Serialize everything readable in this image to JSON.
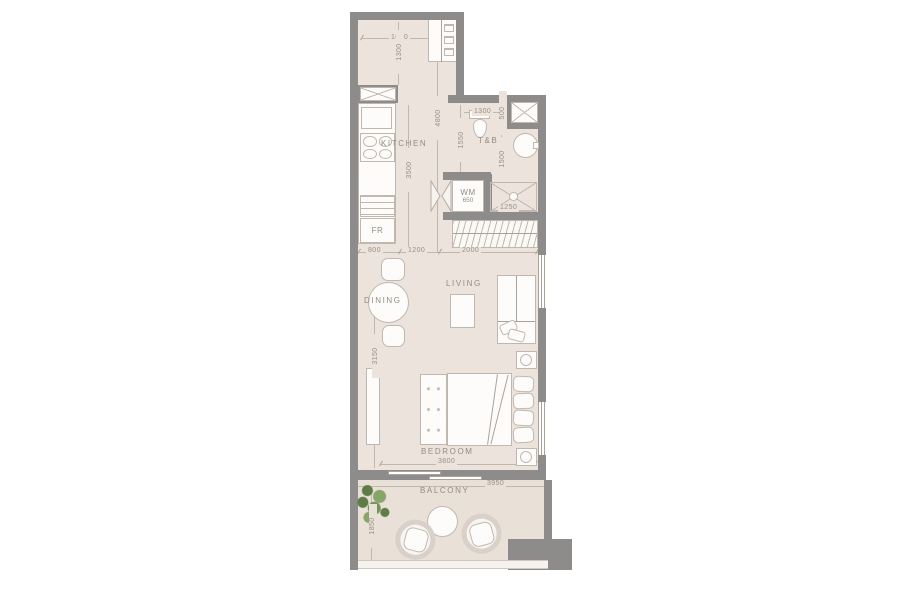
{
  "colors": {
    "wall": "#8d8c8a",
    "floor": "#ece3dc",
    "floorBalcony": "#e9e0d8",
    "line": "#c0b8af",
    "lineStrong": "#aaa29a",
    "text": "#938d84",
    "dimText": "#988f85",
    "furniture": "#fdfcfa",
    "plantDark": "#5e7c47",
    "plantLight": "#87a566"
  },
  "rooms": {
    "kitchen": {
      "label": "KITCHEN"
    },
    "toilet_bath": {
      "label": "T&B"
    },
    "dining": {
      "label": "DINING"
    },
    "living": {
      "label": "LIVING"
    },
    "bedroom": {
      "label": "BEDROOM"
    },
    "balcony": {
      "label": "BALCONY"
    }
  },
  "appliances": {
    "washing_machine": {
      "label": "WM"
    },
    "fridge": {
      "label": "FR"
    }
  },
  "dims": {
    "kitchen_top_width": "1600",
    "kitchen_entry_depth": "1300",
    "kitchen_length": "4800",
    "kitchen_counter_run": "3500",
    "tb_width": "1300",
    "tb_door_offset": "500",
    "tb_left_depth": "1550",
    "tb_right_depth": "1500",
    "wm_niche_width": "650",
    "shower_width": "1250",
    "dining_zone_width": "800",
    "living_zone_offset": "1200",
    "living_zone_width": "2000",
    "living_bedroom_depth": "3150",
    "bedroom_width": "3800",
    "balcony_width": "3950",
    "balcony_depth": "1850"
  },
  "icons": {
    "shaft": "x-cross",
    "duct_vent": "x-cross",
    "shower": "x-cross-with-drain",
    "wm_door": "bifold-triangles",
    "wardrobe_rail": "hanger-hatch",
    "hob": "four-burners",
    "plant": "foliage-cluster",
    "lamp": "concentric-circles"
  }
}
